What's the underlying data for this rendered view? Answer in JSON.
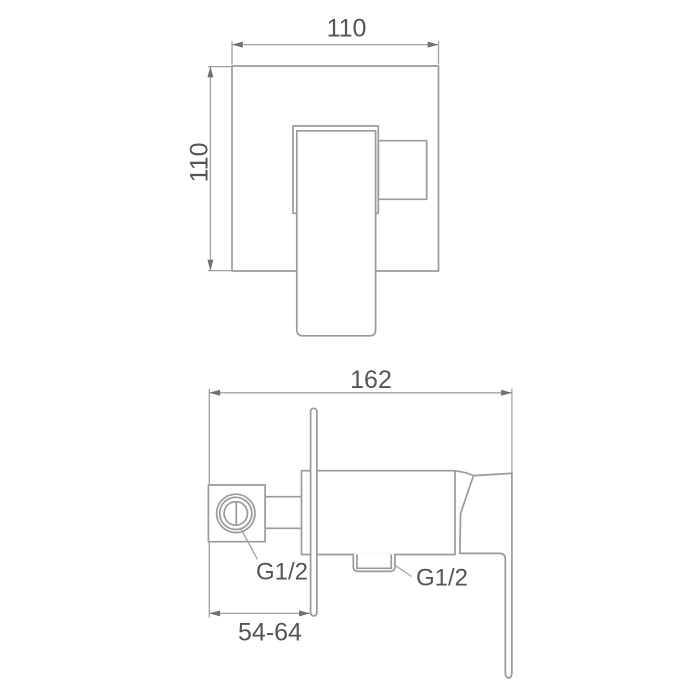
{
  "colors": {
    "background": "#ffffff",
    "outline": "#9a9a9a",
    "dimension_line": "#a2a2a2",
    "arrow": "#707070",
    "text": "#555555"
  },
  "front_view": {
    "width_dim": "110",
    "height_dim": "110"
  },
  "side_view": {
    "width_dim": "162",
    "depth_dim": "54-64",
    "inlet_thread_label": "G1/2",
    "outlet_thread_label": "G1/2"
  }
}
